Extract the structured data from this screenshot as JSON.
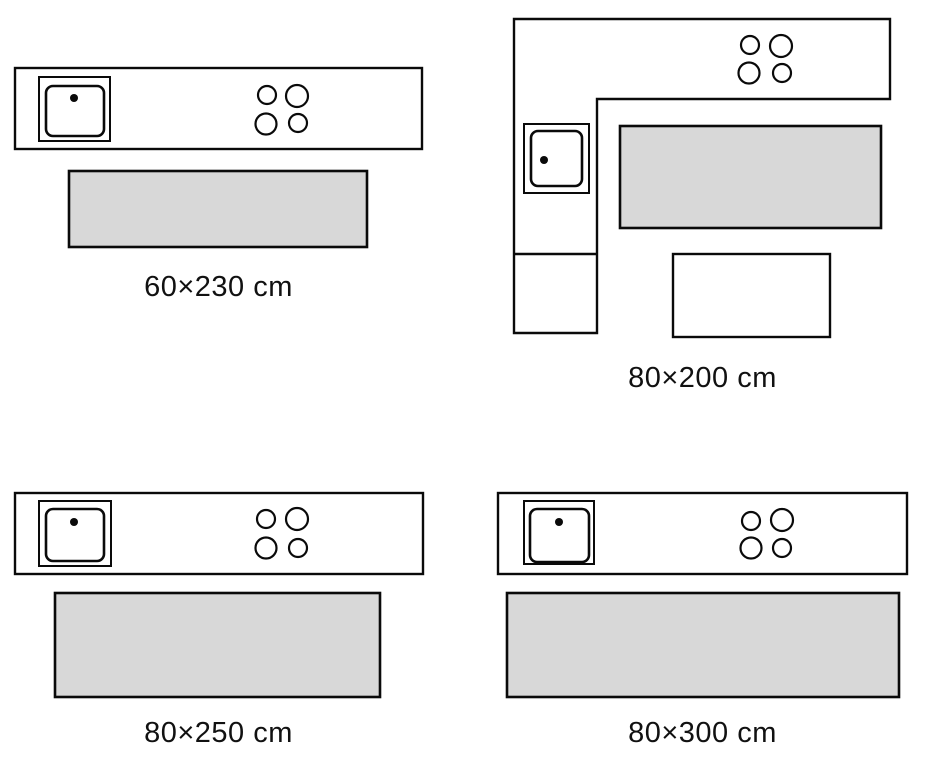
{
  "page": {
    "title": "Kitchen runner rug size guide"
  },
  "colors": {
    "line": "#0a0a0a",
    "rug": "#d8d8d8",
    "surface": "#ffffff",
    "text": "#111111",
    "bg": "#ffffff"
  },
  "icons": [
    "sink-icon",
    "faucet-dot-icon",
    "stove-burners-icon"
  ],
  "diagrams": [
    {
      "id": "runner-60x230",
      "layout": "straight-counter",
      "label": "60×230 cm"
    },
    {
      "id": "runner-80x200",
      "layout": "l-shaped-counter",
      "label": "80×200 cm"
    },
    {
      "id": "runner-80x250",
      "layout": "straight-counter",
      "label": "80×250 cm"
    },
    {
      "id": "runner-80x300",
      "layout": "straight-counter",
      "label": "80×300 cm"
    }
  ]
}
